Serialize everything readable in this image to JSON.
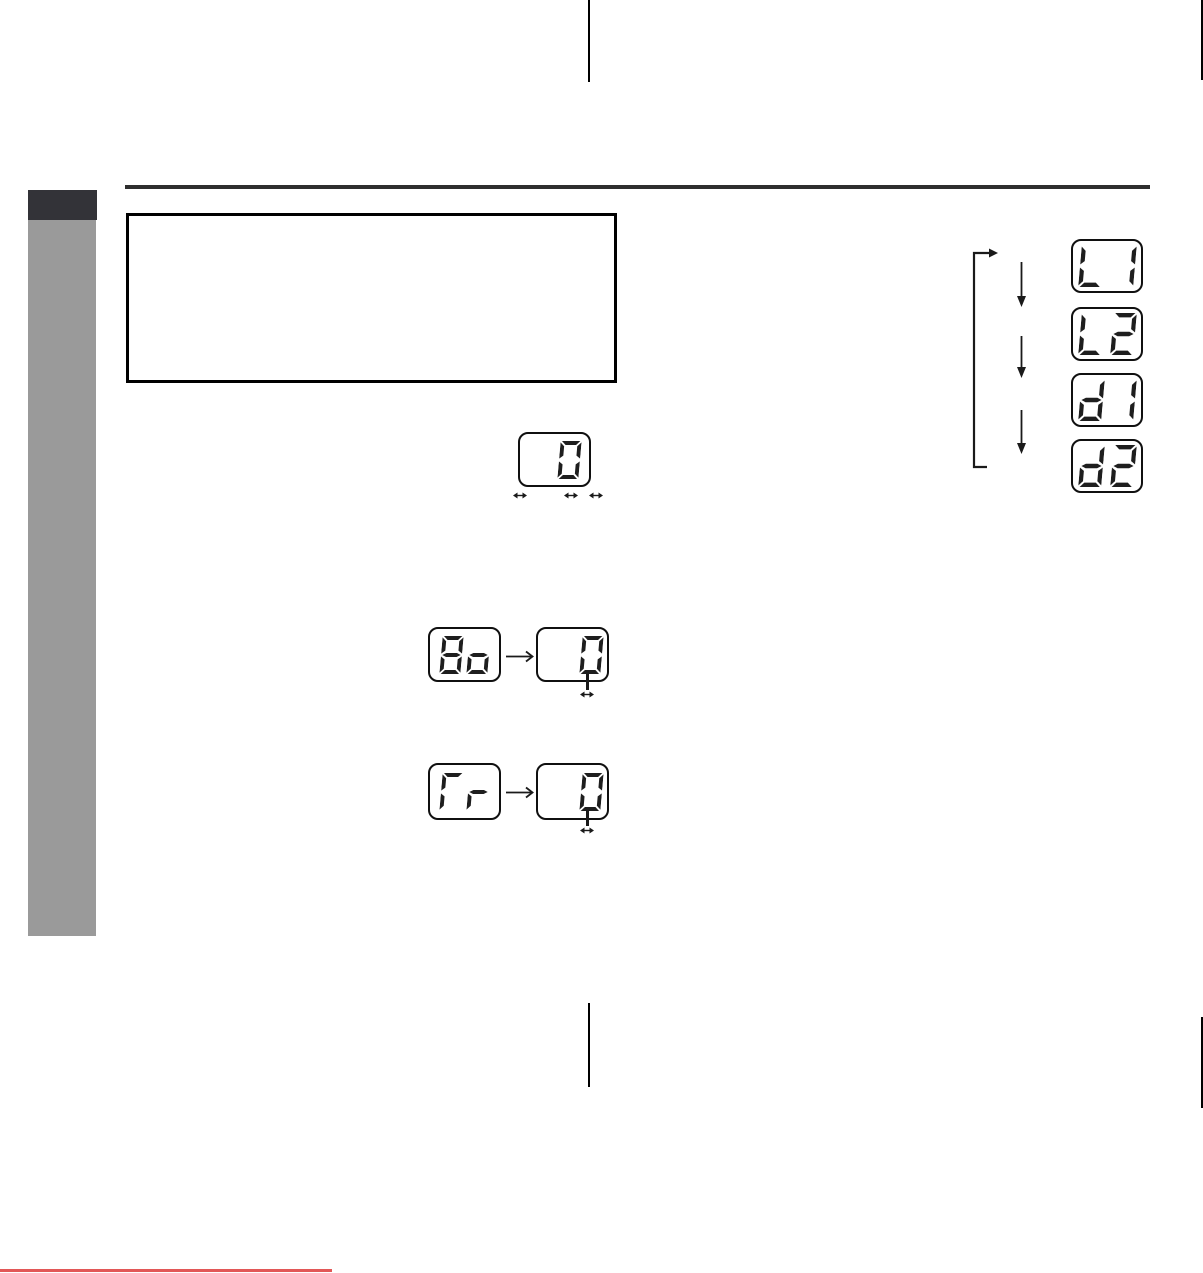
{
  "meta": {
    "page_type": "scanned-manual-page",
    "content_text": ""
  },
  "colors": {
    "page_bg": "#ffffff",
    "segment": "#1e1e1e",
    "display_border": "#101010",
    "note_box_border": "#000000",
    "top_rule": "#2e2e2e",
    "section_tab": "#333338",
    "sidebar_band": "#9a9a9a",
    "fold_mark": "#000000",
    "arrow": "#1a1a1a",
    "bottom_red_line": "#e25757"
  },
  "seven_segment": {
    "glyphs": {
      "0": "abcdef",
      "1": "bc",
      "2": "abdeg",
      "8": "abcdefg",
      "o": "cdeg",
      "L": "def",
      "d": "bcdeg",
      "r": "eg",
      "Γ": "aef"
    },
    "displays": {
      "single_value": "0",
      "balance_label": "8o",
      "balance_value": "0",
      "fader_label": "Γr",
      "fader_value": "0",
      "cycle_items": [
        "L1",
        "L2",
        "d1",
        "d2"
      ]
    }
  },
  "icons": {
    "adjust": "left-right-arrow",
    "next": "right-arrow",
    "step": "down-arrow",
    "loop": "loop-back-bracket"
  }
}
